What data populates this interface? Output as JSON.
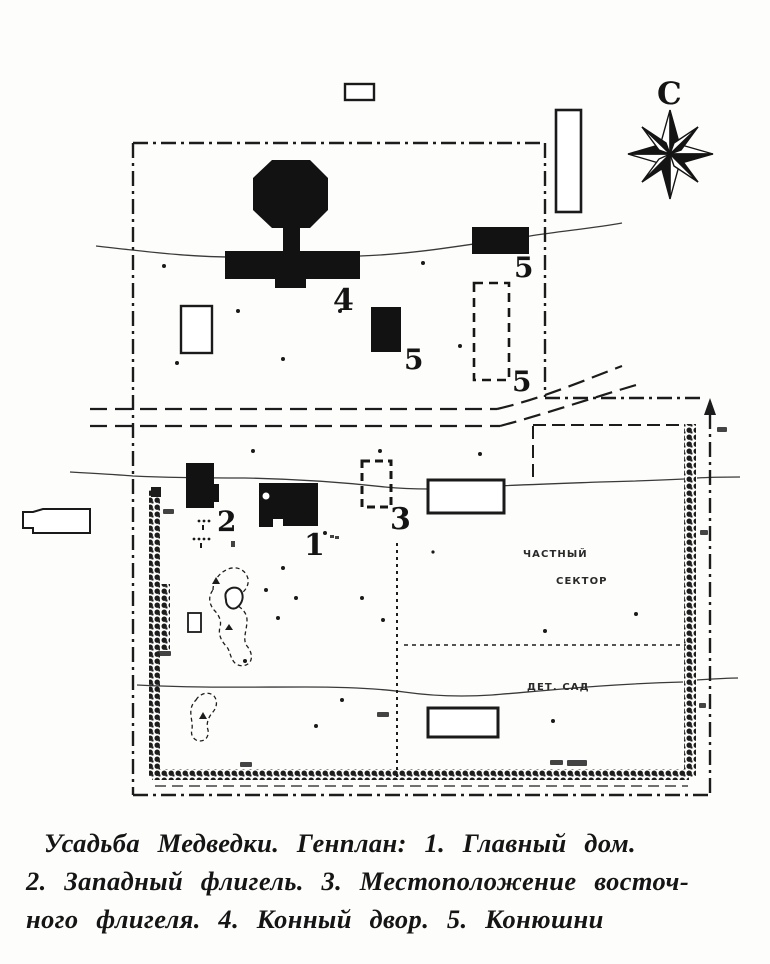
{
  "colors": {
    "ink": "#171717",
    "paper": "#ffffff"
  },
  "compass": {
    "north_label": "С"
  },
  "map_labels": {
    "main_house": "1",
    "west_wing": "2",
    "east_wing_site": "3",
    "horse_yard": "4",
    "stable_a": "5",
    "stable_b": "5",
    "stable_c": "5"
  },
  "area_labels": {
    "private_sector_line1": "ЧАСТНЫЙ",
    "private_sector_line2": "СЕКТОР",
    "kindergarten": "ДЕТ. САД"
  },
  "caption": {
    "line1": "Усадьба Медведки. Генплан: 1. Главный дом.",
    "line2": "2. Западный флигель. 3. Местоположение восточ-",
    "line3": "ного флигеля. 4. Конный двор. 5. Конюшни"
  }
}
